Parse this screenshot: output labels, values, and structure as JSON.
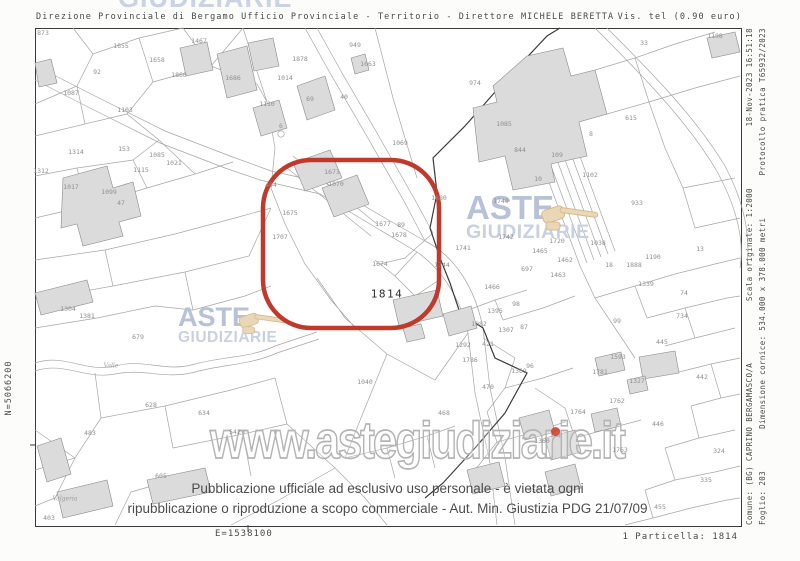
{
  "header": {
    "left": "Direzione Provinciale di Bergamo  Ufficio Provinciale - Territorio - Direttore MICHELE BERETTA",
    "right": "Vis. tel (0.90 euro)"
  },
  "watermarks": {
    "top_partial": "GIUDIZIARIE",
    "aste": "ASTE",
    "giudiziarie": "GIUDIZIARIE",
    "url": "www.astegiudiziarie.it"
  },
  "disclaimer": {
    "line1": "Pubblicazione ufficiale ad esclusivo uso personale - è vietata ogni",
    "line2": "ripubblicazione o riproduzione a scopo commerciale - Aut. Min. Giustizia PDG 21/07/09"
  },
  "margins": {
    "east": "E=1538100",
    "north": "N=5066200",
    "particella": "1 Particella: 1814",
    "right_col1": [
      "Comune: (BG) CAPRINO BERGAMASCO/A",
      "Scala originale: 1:2000",
      "18-Nov-2023 16:51:18"
    ],
    "right_col2": [
      "Foglio: 203",
      "Dimensione cornice: 534.000 x 378.000 metri",
      "Protocollo pratica T65932/2023"
    ]
  },
  "colors": {
    "highlight_red": "#C0392B",
    "watermark_blue": "#B7C1D8",
    "watermark_outline": "#B4B4B4",
    "gavel_beige": "#EAD7B5",
    "parcel_line_gray": "#A3A3A3",
    "building_fill": "#DBDBDB",
    "text_gray": "#4A4A4A"
  },
  "map": {
    "highlight_parcel": "1814",
    "parcel_labels": [
      {
        "t": "873",
        "x": 8,
        "y": 5
      },
      {
        "t": "92",
        "x": 62,
        "y": 44
      },
      {
        "t": "1655",
        "x": 86,
        "y": 18
      },
      {
        "t": "1658",
        "x": 122,
        "y": 32
      },
      {
        "t": "1467",
        "x": 164,
        "y": 13
      },
      {
        "t": "1860",
        "x": 144,
        "y": 47
      },
      {
        "t": "1686",
        "x": 198,
        "y": 50
      },
      {
        "t": "1087",
        "x": 36,
        "y": 65
      },
      {
        "t": "1103",
        "x": 90,
        "y": 82
      },
      {
        "t": "1110",
        "x": 232,
        "y": 76
      },
      {
        "t": "1014",
        "x": 250,
        "y": 50
      },
      {
        "t": "1878",
        "x": 265,
        "y": 31
      },
      {
        "t": "949",
        "x": 320,
        "y": 17
      },
      {
        "t": "1063",
        "x": 333,
        "y": 36
      },
      {
        "t": "69",
        "x": 275,
        "y": 71
      },
      {
        "t": "40",
        "x": 309,
        "y": 69
      },
      {
        "t": "6",
        "x": 246,
        "y": 98
      },
      {
        "t": "1069",
        "x": 365,
        "y": 115
      },
      {
        "t": "33",
        "x": 609,
        "y": 15
      },
      {
        "t": "1198",
        "x": 680,
        "y": 8
      },
      {
        "t": "974",
        "x": 440,
        "y": 55
      },
      {
        "t": "1085",
        "x": 469,
        "y": 96
      },
      {
        "t": "615",
        "x": 596,
        "y": 90
      },
      {
        "t": "8",
        "x": 556,
        "y": 106
      },
      {
        "t": "844",
        "x": 485,
        "y": 122
      },
      {
        "t": "109",
        "x": 522,
        "y": 127
      },
      {
        "t": "10",
        "x": 503,
        "y": 151
      },
      {
        "t": "1102",
        "x": 555,
        "y": 147
      },
      {
        "t": "933",
        "x": 602,
        "y": 175
      },
      {
        "t": "1880",
        "x": 404,
        "y": 170
      },
      {
        "t": "13",
        "x": 665,
        "y": 221
      },
      {
        "t": "1190",
        "x": 618,
        "y": 229
      },
      {
        "t": "1888",
        "x": 599,
        "y": 237
      },
      {
        "t": "1038",
        "x": 563,
        "y": 215
      },
      {
        "t": "1720",
        "x": 522,
        "y": 213
      },
      {
        "t": "1749",
        "x": 466,
        "y": 173
      },
      {
        "t": "1742",
        "x": 471,
        "y": 209
      },
      {
        "t": "1741",
        "x": 428,
        "y": 220
      },
      {
        "t": "1465",
        "x": 505,
        "y": 223
      },
      {
        "t": "1462",
        "x": 530,
        "y": 232
      },
      {
        "t": "1463",
        "x": 523,
        "y": 247
      },
      {
        "t": "18",
        "x": 574,
        "y": 237
      },
      {
        "t": "697",
        "x": 492,
        "y": 241
      },
      {
        "t": "1744",
        "x": 407,
        "y": 237
      },
      {
        "t": "404",
        "x": 236,
        "y": 157
      },
      {
        "t": "1673",
        "x": 297,
        "y": 144
      },
      {
        "t": "1070",
        "x": 301,
        "y": 156
      },
      {
        "t": "1675",
        "x": 255,
        "y": 185
      },
      {
        "t": "1707",
        "x": 245,
        "y": 209
      },
      {
        "t": "1677",
        "x": 348,
        "y": 196
      },
      {
        "t": "89",
        "x": 366,
        "y": 197
      },
      {
        "t": "1678",
        "x": 364,
        "y": 207
      },
      {
        "t": "1674",
        "x": 345,
        "y": 236
      },
      {
        "t": "1814",
        "x": 352,
        "y": 266,
        "b": 1
      },
      {
        "t": "1339",
        "x": 611,
        "y": 256
      },
      {
        "t": "74",
        "x": 649,
        "y": 265
      },
      {
        "t": "734",
        "x": 647,
        "y": 288
      },
      {
        "t": "445",
        "x": 627,
        "y": 314
      },
      {
        "t": "99",
        "x": 582,
        "y": 293
      },
      {
        "t": "1593",
        "x": 583,
        "y": 329
      },
      {
        "t": "1327",
        "x": 602,
        "y": 353
      },
      {
        "t": "442",
        "x": 667,
        "y": 349
      },
      {
        "t": "1781",
        "x": 565,
        "y": 344
      },
      {
        "t": "1762",
        "x": 582,
        "y": 373
      },
      {
        "t": "1764",
        "x": 543,
        "y": 384
      },
      {
        "t": "446",
        "x": 623,
        "y": 396
      },
      {
        "t": "324",
        "x": 684,
        "y": 423
      },
      {
        "t": "335",
        "x": 671,
        "y": 452
      },
      {
        "t": "455",
        "x": 625,
        "y": 479
      },
      {
        "t": "450",
        "x": 499,
        "y": 462
      },
      {
        "t": "1763",
        "x": 585,
        "y": 422
      },
      {
        "t": "1360",
        "x": 507,
        "y": 413
      },
      {
        "t": "1466",
        "x": 457,
        "y": 259
      },
      {
        "t": "98",
        "x": 481,
        "y": 276
      },
      {
        "t": "1395",
        "x": 460,
        "y": 283
      },
      {
        "t": "1307",
        "x": 471,
        "y": 302
      },
      {
        "t": "87",
        "x": 489,
        "y": 299
      },
      {
        "t": "1082",
        "x": 444,
        "y": 296
      },
      {
        "t": "1292",
        "x": 428,
        "y": 317
      },
      {
        "t": "421",
        "x": 453,
        "y": 316
      },
      {
        "t": "1786",
        "x": 435,
        "y": 332
      },
      {
        "t": "96",
        "x": 495,
        "y": 338
      },
      {
        "t": "1369",
        "x": 484,
        "y": 343
      },
      {
        "t": "470",
        "x": 453,
        "y": 359
      },
      {
        "t": "468",
        "x": 409,
        "y": 385
      },
      {
        "t": "1040",
        "x": 330,
        "y": 354
      },
      {
        "t": "1304",
        "x": 33,
        "y": 281
      },
      {
        "t": "1381",
        "x": 52,
        "y": 288
      },
      {
        "t": "679",
        "x": 103,
        "y": 309
      },
      {
        "t": "628",
        "x": 116,
        "y": 377
      },
      {
        "t": "634",
        "x": 169,
        "y": 385
      },
      {
        "t": "483",
        "x": 55,
        "y": 405
      },
      {
        "t": "542",
        "x": 200,
        "y": 404
      },
      {
        "t": "605",
        "x": 126,
        "y": 448
      },
      {
        "t": "403",
        "x": 14,
        "y": 490
      },
      {
        "t": "1017",
        "x": 36,
        "y": 159
      },
      {
        "t": "1115",
        "x": 106,
        "y": 142
      },
      {
        "t": "1314",
        "x": 41,
        "y": 124
      },
      {
        "t": "1312",
        "x": 6,
        "y": 143
      },
      {
        "t": "153",
        "x": 89,
        "y": 121
      },
      {
        "t": "1085",
        "x": 122,
        "y": 127
      },
      {
        "t": "1021",
        "x": 139,
        "y": 135
      },
      {
        "t": "1099",
        "x": 74,
        "y": 164
      },
      {
        "t": "47",
        "x": 86,
        "y": 175
      },
      {
        "t": "Valgeria",
        "x": 30,
        "y": 471,
        "i": 1
      },
      {
        "t": "Valle",
        "x": 76,
        "y": 338,
        "i": 1
      }
    ]
  }
}
